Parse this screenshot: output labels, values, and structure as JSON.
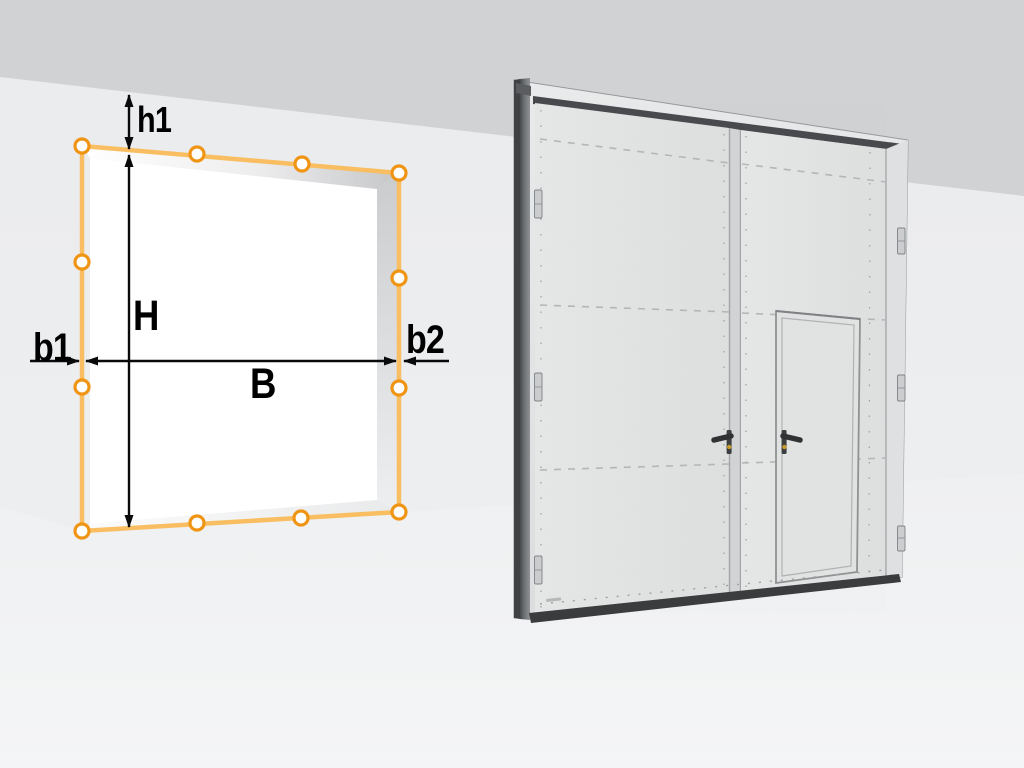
{
  "scene": {
    "type": "door-opening-measurement-diagram",
    "dimension_labels": {
      "h1": "h1",
      "H": "H",
      "B": "B",
      "b1": "b1",
      "b2": "b2"
    },
    "opening": {
      "marker_count": 12,
      "marker_shape": "circle"
    },
    "door_preview": {
      "leaves": 2,
      "wicket_door": true,
      "handles": 2,
      "hinges_visible": 6
    }
  },
  "colors": {
    "marker_orange": "#EF9413",
    "outline_amber": "#F9BE62",
    "dimension_line": "#0A0A0A",
    "ceiling_band": "#D1D2D4",
    "wall": "#ECEDEE",
    "floor": "#F2F3F4",
    "opening_interior": "#FFFFFF",
    "door_panel": "#E3E4E4",
    "door_frame_dark": "#53565A",
    "threshold_dark": "#393B3D",
    "handle_dark": "#2E3032",
    "keyhole_gold": "#C79A2A"
  }
}
